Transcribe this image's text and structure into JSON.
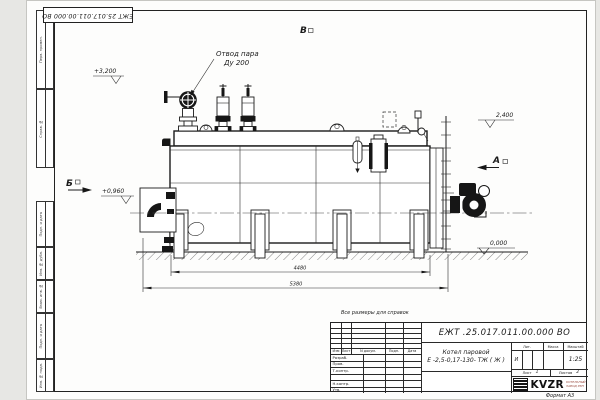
{
  "sheet": {
    "stamp_rotated": "ЕЖТ 25.017.011.00.000  ВО",
    "format_note": "Формат А3",
    "side_strip": [
      "Перв. примен.",
      "Справ. №",
      "Подп. и дата",
      "Инв. № дубл.",
      "Взам. инв. №",
      "Подп. и дата",
      "Инв. № подл."
    ]
  },
  "drawing": {
    "note": "Все размеры для справок",
    "steam_label_line1": "Отвод пара",
    "steam_label_line2": "Ду 200",
    "elev_top": "+3,200",
    "elev_right": "2,400",
    "elev_mid": "+0,960",
    "elev_ground": "0,000",
    "view_v": "В",
    "view_a": "А",
    "view_b": "Б",
    "dim_inner": "4480",
    "dim_outer": "5380"
  },
  "title_block": {
    "doc_number": "ЕЖТ .25.017.011.00.000  ВО",
    "product_line1": "Котел паровой",
    "product_line2": "Е -2,5-0,17-130- ТЖ ( Ж )",
    "cols": [
      "Изм",
      "Лист",
      "N докум.",
      "Подп.",
      "Дата"
    ],
    "rows": [
      "Разраб.",
      "Пров.",
      "Т.контр.",
      "Н.контр.",
      "Утв."
    ],
    "lit_label": "Лит.",
    "mass_label": "Масса",
    "scale_label": "Масштаб",
    "lit_value": "И",
    "scale_value": "1:25",
    "sheet_label": "Лист",
    "sheet_value": "1",
    "sheets_label": "Листов",
    "sheets_value": "2",
    "logo_text": "KVZR",
    "logo_sub_line1": "КОТЕЛЬНЫЙ",
    "logo_sub_line2": "ЗАВОД РЭП"
  }
}
